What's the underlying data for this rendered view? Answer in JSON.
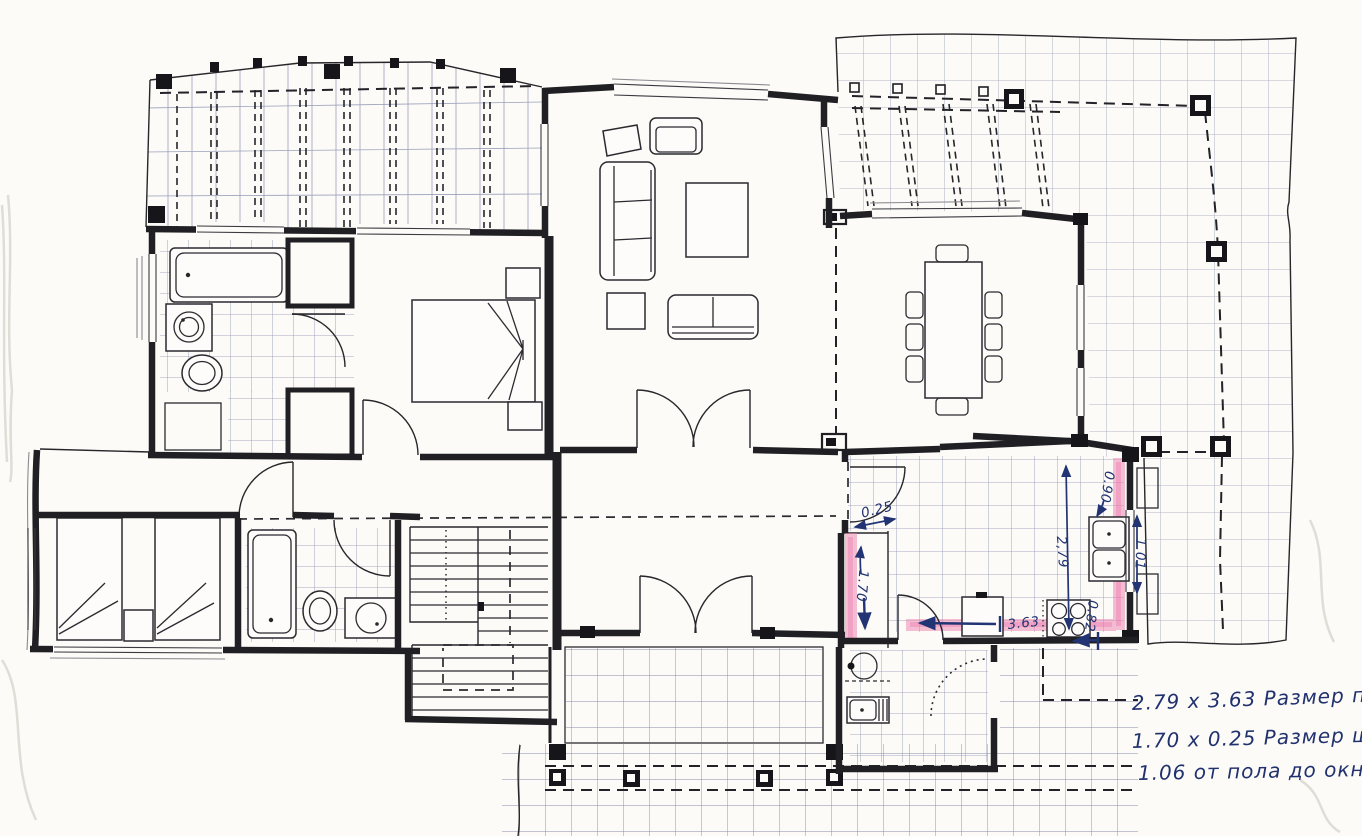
{
  "document_kind": "floor-plan-scan",
  "colors": {
    "paper": "#fcfbf7",
    "ink": "#1f1f24",
    "tile_grid": "#8a90ae",
    "terrace_grid": "#9aa0ba",
    "highlight_pink": "#ee7fae",
    "pen_blue": "#223473"
  },
  "dims": {
    "cabinet_depth": "0.25",
    "cabinet_length": "1.70",
    "kitchen_depth": "2,79",
    "kitchen_width": "3.63",
    "window_above": "0.90",
    "window_height": "1.01",
    "window_below": "0.82"
  },
  "notes": {
    "line1": "2.79  x 3.63  Размер по с",
    "line2": "1.70  x 0.25  Размер шкафа",
    "line3": "1.06  от пола до окна."
  }
}
